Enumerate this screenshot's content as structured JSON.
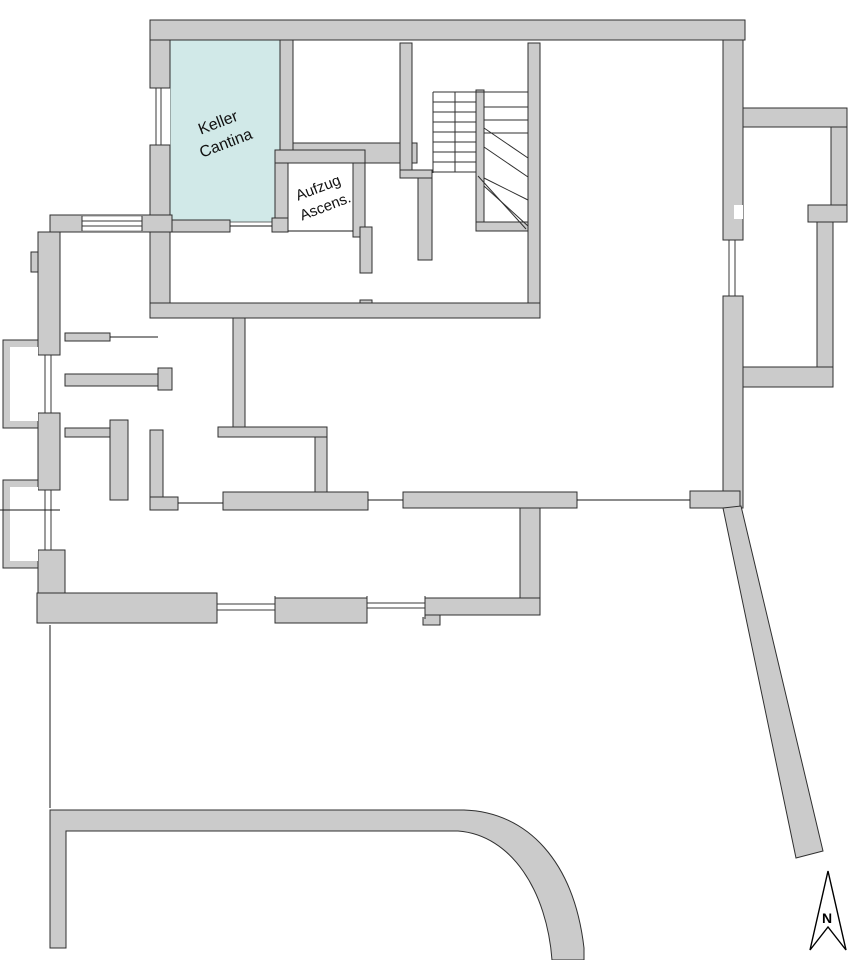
{
  "plan": {
    "labels": {
      "keller_cantina": {
        "line1": "Keller",
        "line2": "Cantina"
      },
      "aufzug": {
        "line1": "Aufzug",
        "line2": "Ascens."
      },
      "north": "N"
    },
    "colors": {
      "wall_fill": "#cbcbcb",
      "wall_outline": "#2f2f2f",
      "highlight_room_fill": "#d1e9e8",
      "thin_line": "#000000",
      "background": "#ffffff"
    },
    "features": [
      "keller-cantina-room",
      "elevator-shaft",
      "staircase",
      "light-wells",
      "windows",
      "curved-retaining-wall",
      "diagonal-boundary-wall",
      "north-arrow"
    ]
  }
}
